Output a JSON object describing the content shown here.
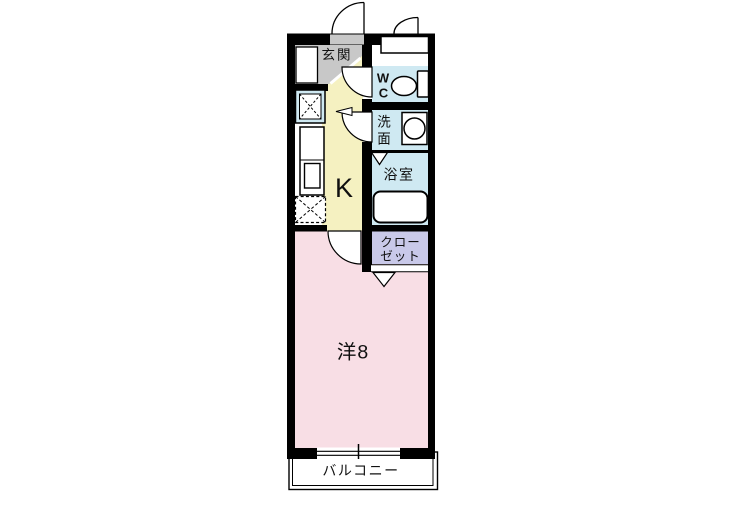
{
  "labels": {
    "entrance": "玄関",
    "wc_1": "W",
    "wc_2": "C",
    "washroom_1": "洗",
    "washroom_2": "面",
    "bathroom": "浴室",
    "closet_1": "クロー",
    "closet_2": "ゼット",
    "kitchen": "K",
    "main_room": "洋8",
    "balcony": "バルコニー"
  },
  "colors": {
    "wall": "#000000",
    "entrance": "#c8c8c8",
    "kitchen": "#f5f1c1",
    "wet_area": "#cfe9f2",
    "closet": "#c9c9e9",
    "main_room": "#f8dee5",
    "fixture": "#ffffff"
  }
}
